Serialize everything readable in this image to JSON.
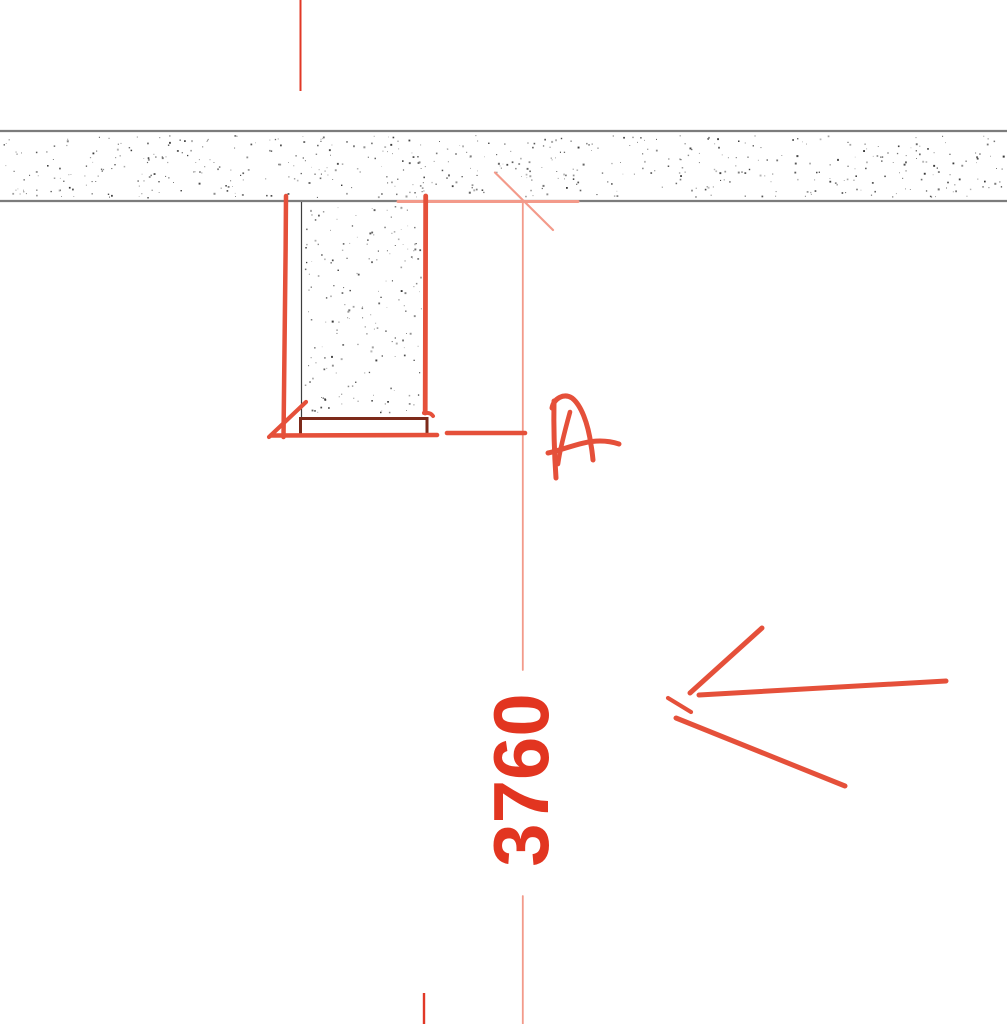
{
  "canvas": {
    "width": 1007,
    "height": 1024,
    "kind": "cad-plan-view-with-markup"
  },
  "drawing": {
    "dimension": {
      "value": "3760",
      "orientation": "vertical-rotated-90ccw"
    },
    "annotation": {
      "letter": "A"
    },
    "colors": {
      "canvas_bg": "#ffffff",
      "wall_edge_gray": "#7c7c7c",
      "detail_line_black": "#3d3d3d",
      "sill_maroon": "#7d2a1a",
      "markup_red": "#e5503a",
      "dimension_salmon": "#f39a8a",
      "dimension_text_red": "#e23520",
      "grid_line_red": "#e13826",
      "stipple_gray": "#6e6e6e"
    }
  }
}
